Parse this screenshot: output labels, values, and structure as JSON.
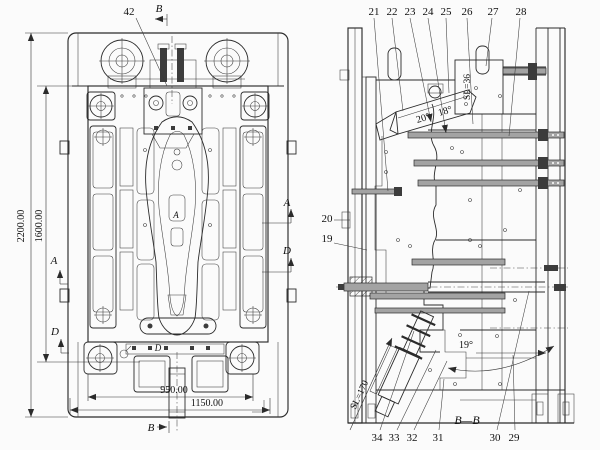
{
  "canvas": {
    "background": "#fbfbfb",
    "ink": "#2b2b2b"
  },
  "plan_view": {
    "dims": {
      "outer_height": "2200.00",
      "inner_height": "1600.00",
      "inner_width": "950.00",
      "outer_width": "1150.00"
    },
    "callout_42": "42",
    "markers": {
      "b_top": "B",
      "b_bottom": "B",
      "a_left": "A",
      "d_left": "D",
      "a_right": "A",
      "d_right": "D",
      "a_inner": "A",
      "d_inner": "D"
    }
  },
  "section_view": {
    "title": "B—B",
    "top_callouts": [
      "21",
      "22",
      "23",
      "24",
      "25",
      "26",
      "27",
      "28"
    ],
    "left_callouts": {
      "c20": "20",
      "c19": "19"
    },
    "bottom_callouts": [
      "34",
      "33",
      "32",
      "31",
      "30",
      "29"
    ],
    "angles": {
      "left": "20°",
      "right": "18°",
      "lower": "19°"
    },
    "strokes": {
      "upper": "SL=36",
      "lower": "SL=170"
    }
  }
}
